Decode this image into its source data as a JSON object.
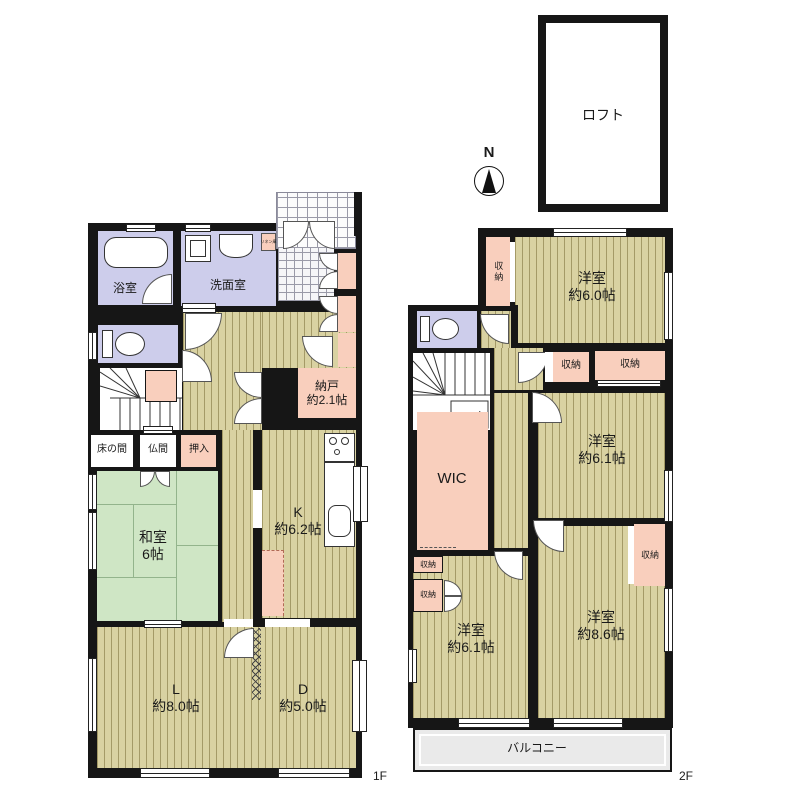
{
  "compass": {
    "north": "N"
  },
  "loft": {
    "label": "ロフト"
  },
  "floor1": {
    "label": "1F",
    "bath": "浴室",
    "washroom": "洗面室",
    "linen": "リネン庫",
    "storeroom": {
      "l1": "納戸",
      "l2": "約2.1帖"
    },
    "tokonoma": "床の間",
    "butsuma": "仏間",
    "oshiire": "押入",
    "washitsu": {
      "l1": "和室",
      "l2": "6帖"
    },
    "kitchen": {
      "l1": "K",
      "l2": "約6.2帖"
    },
    "living": {
      "l1": "L",
      "l2": "約8.0帖"
    },
    "dining": {
      "l1": "D",
      "l2": "約5.0帖"
    }
  },
  "floor2": {
    "label": "2F",
    "storage": "収納",
    "wic": "WIC",
    "room60": {
      "l1": "洋室",
      "l2": "約6.0帖"
    },
    "room61e": {
      "l1": "洋室",
      "l2": "約6.1帖"
    },
    "room61w": {
      "l1": "洋室",
      "l2": "約6.1帖"
    },
    "room86": {
      "l1": "洋室",
      "l2": "約8.6帖"
    },
    "balcony": "バルコニー"
  }
}
